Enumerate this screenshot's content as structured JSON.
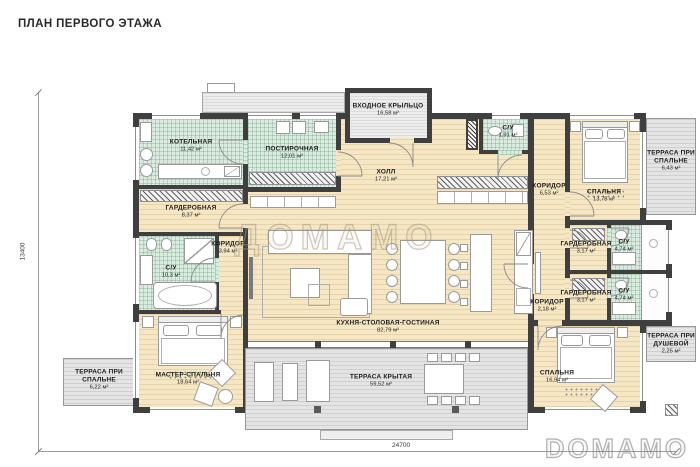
{
  "title": "ПЛАН ПЕРВОГО ЭТАЖА",
  "watermarks": {
    "center": "ДОМАМО",
    "corner": "DOMAMO"
  },
  "dimensions": {
    "width_mm": "24700",
    "height_mm": "13400"
  },
  "colors": {
    "wall": "#3f3f3f",
    "floor_wood": "#f6e7c4",
    "floor_tile": "#d9ecdf",
    "terrace": "#e4e4e4"
  },
  "rooms": {
    "boiler": {
      "name": "КОТЕЛЬНАЯ",
      "area": "11,42 м²"
    },
    "laundry": {
      "name": "ПОСТИРОЧНАЯ",
      "area": "12,01 м²"
    },
    "porch": {
      "name": "ВХОДНОЕ КРЫЛЬЦО",
      "area": "16,58 м²"
    },
    "hall": {
      "name": "ХОЛЛ",
      "area": "17,21 м²"
    },
    "wc_hall": {
      "name": "С/У",
      "area": "1,91 м²"
    },
    "corridor_hall": {
      "name": "КОРИДОР",
      "area": "6,53 м²"
    },
    "bedroom_top": {
      "name": "СПАЛЬНЯ",
      "area": "13,78 м²"
    },
    "terrace_bedroom_top": {
      "name": "ТЕРРАСА ПРИ СПАЛЬНЕ",
      "area": "6,43 м²"
    },
    "wardrobe_main": {
      "name": "ГАРДЕРОБНАЯ",
      "area": "8,37 м²"
    },
    "corridor_master": {
      "name": "КОРИДОР",
      "area": "3,94 м²"
    },
    "bathroom_master": {
      "name": "С/У",
      "area": "10,3 м²"
    },
    "wardrobe_1": {
      "name": "ГАРДЕРОБНАЯ",
      "area": "3,17 м²"
    },
    "wc_1": {
      "name": "С/У",
      "area": "4,74 м²"
    },
    "wardrobe_2": {
      "name": "ГАРДЕРОБНАЯ",
      "area": "3,17 м²"
    },
    "wc_2": {
      "name": "С/У",
      "area": "4,74 м²"
    },
    "corridor_small": {
      "name": "КОРИДОР",
      "area": "2,18 м²"
    },
    "kitchen_living": {
      "name": "КУХНЯ-СТОЛОВАЯ-ГОСТИНАЯ",
      "area": "82,79 м²"
    },
    "master_bedroom": {
      "name": "МАСТЕР-СПАЛЬНЯ",
      "area": "18,64 м²"
    },
    "terrace_master": {
      "name": "ТЕРРАСА ПРИ СПАЛЬНЕ",
      "area": "6,22 м²"
    },
    "terrace_covered": {
      "name": "ТЕРРАСА КРЫТАЯ",
      "area": "59,52 м²"
    },
    "bedroom_bottom": {
      "name": "СПАЛЬНЯ",
      "area": "16,94 м²"
    },
    "terrace_shower": {
      "name": "ТЕРРАСА ПРИ ДУШЕВОЙ",
      "area": "2,25 м²"
    }
  }
}
